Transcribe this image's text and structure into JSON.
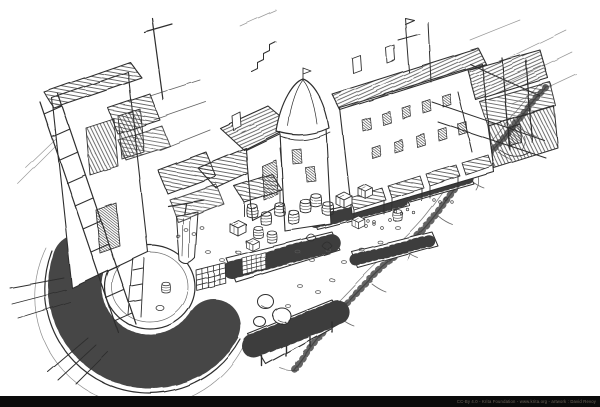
{
  "page": {
    "width": 600,
    "height": 407,
    "paper_color": "#ffffff"
  },
  "artwork": {
    "alt": "Black-and-white isometric pen-and-ink sketch of a cluttered medieval market street: ramshackle multi-storey houses with plank roofs, a round tower with a bell-shaped roof, market stalls with striped awnings, barrels, crates and pallet grates along a diagonal lane; in the foreground a circular plaza with wooden planks radiating outward, a plank pier jutting toward an empty white void at the lower right, and a tall ladder scaffold on the left.",
    "medium": "pen and ink line drawing on white paper",
    "ink_color": "#2f2f2f",
    "paper_color": "#ffffff"
  },
  "footer": {
    "bar_color": "#0b0b0b",
    "credit_color": "#6f665b",
    "credit_text": "CC-By 4.0 - Krita Foundation - www.krita.org - artwork : David Revoy"
  }
}
